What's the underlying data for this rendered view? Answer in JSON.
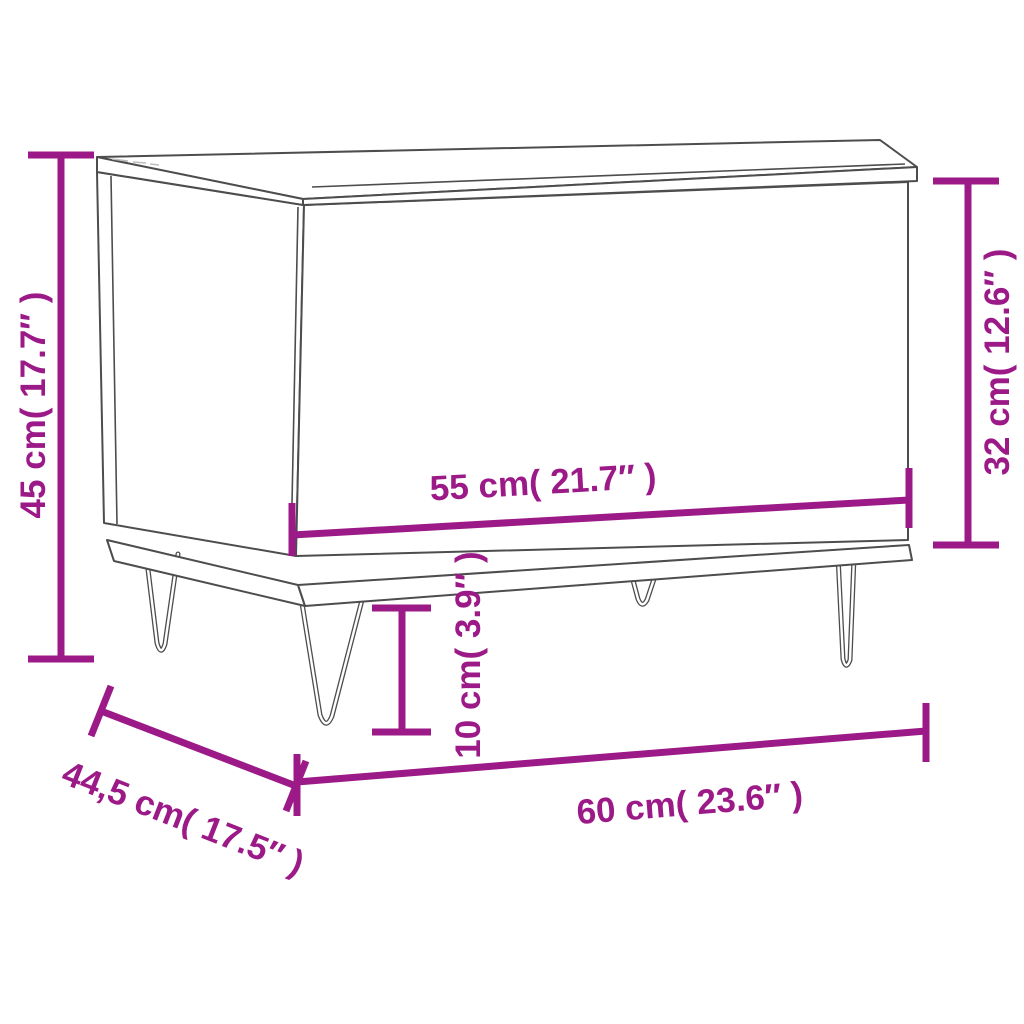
{
  "title": "Coffee table dimension diagram",
  "product": "lift-top coffee table with hairpin legs",
  "colors": {
    "dimension": "#9C1A87",
    "outline": "#4D4D4D",
    "background": "#FFFFFF"
  },
  "labels": {
    "overall_height": "45 cm( 17.7″ )",
    "top_section_height": "32 cm( 12.6″ )",
    "top_width": "55 cm( 21.7″ )",
    "leg_height": "10 cm( 3.9″ )",
    "overall_width": "60 cm( 23.6″ )",
    "depth": "44,5 cm( 17.5″ )"
  }
}
